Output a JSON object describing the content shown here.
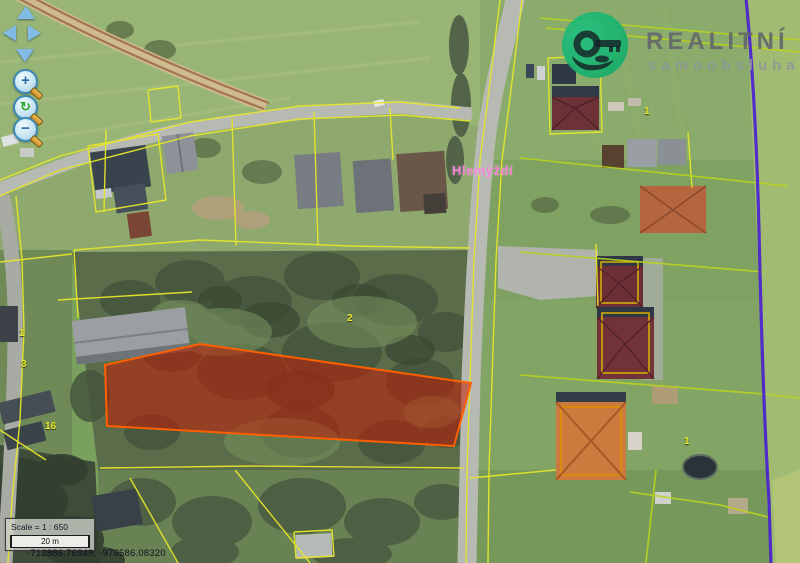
{
  "brand": {
    "name": "REALITNÍ",
    "tagline": "samoobsluha",
    "logo_icon": "key-in-hand-circle-icon",
    "color": "#1eb473"
  },
  "map": {
    "place_label": "Hlemýždí",
    "parcel_labels": [
      {
        "text": "2"
      },
      {
        "text": "1"
      },
      {
        "text": "1"
      },
      {
        "text": "16"
      },
      {
        "text": "3"
      },
      {
        "text": "1"
      }
    ],
    "colors": {
      "parcel_boundary": "#e6e62c",
      "selected_parcel_fill": "#c31e08",
      "selected_parcel_stroke": "#ff5f00",
      "district_boundary": "#4a22cf",
      "place_label": "#f583d8"
    }
  },
  "controls": {
    "pan_up_icon": "triangle-up",
    "pan_down_icon": "triangle-down",
    "pan_left_icon": "triangle-left",
    "pan_right_icon": "triangle-right",
    "zoom_in_glyph": "+",
    "zoom_out_glyph": "−",
    "reset_glyph": "↻"
  },
  "scale_panel": {
    "scale_text": "Scale = 1 : 650",
    "bar_label": "20 m"
  },
  "status": {
    "coordinates": "-712886.76849, -976586.08320"
  }
}
